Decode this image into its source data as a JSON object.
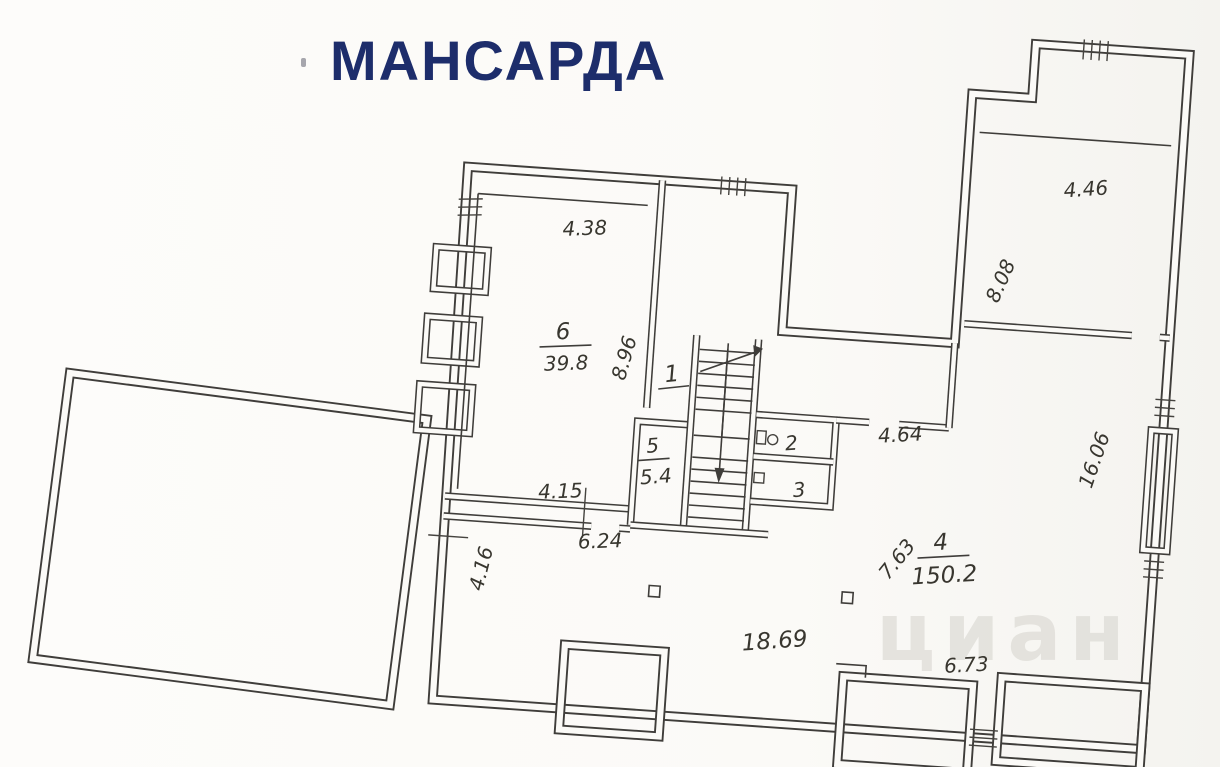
{
  "title": "МАНСАРДА",
  "watermark": "циан",
  "colors": {
    "title": "#1d2d6b",
    "line": "#3f3d3a",
    "background": "#fbfaf7",
    "watermark": "#d8d6d0"
  },
  "rooms": {
    "r1": {
      "number": "1"
    },
    "r2": {
      "number": "2"
    },
    "r3": {
      "number": "3"
    },
    "r4": {
      "number": "4",
      "area": "150.2"
    },
    "r5": {
      "number": "5",
      "area": "5.4"
    },
    "r6": {
      "number": "6",
      "area": "39.8"
    }
  },
  "dims": {
    "room6_top": "4.38",
    "room6_side": "8.96",
    "room6_south": "4.15",
    "passage_south": "6.24",
    "left_lower": "4.16",
    "corridor_east": "4.64",
    "wing_top": "4.46",
    "wing_left": "8.08",
    "wing_right": "16.06",
    "room4_diag": "7.63",
    "room4_width": "18.69",
    "room4_southeast": "6.73"
  }
}
